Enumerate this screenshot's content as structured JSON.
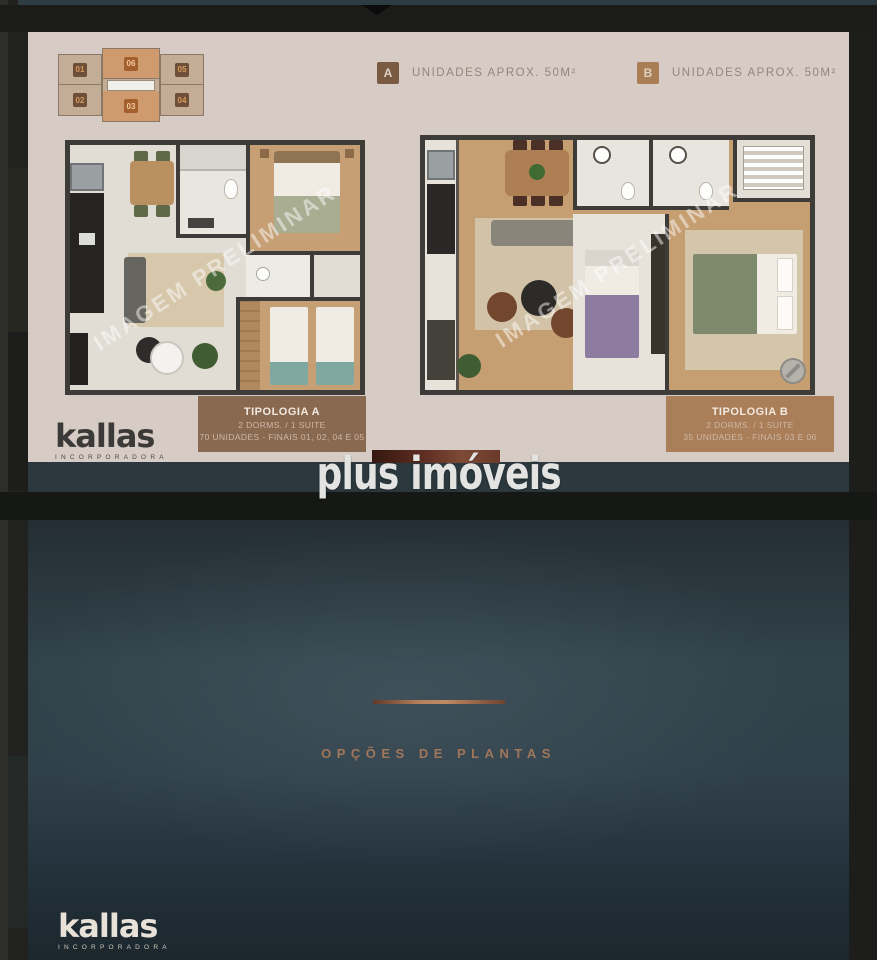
{
  "brand": {
    "wordmark": "kallas",
    "subtitle": "INCORPORADORA"
  },
  "overlay": {
    "watermark_text": "plus imóveis"
  },
  "top_slide": {
    "plan_watermark": "IMAGEM PRELIMINAR",
    "legend": [
      {
        "key": "A",
        "label": "UNIDADES APROX. 50M²"
      },
      {
        "key": "B",
        "label": "UNIDADES APROX. 50M²"
      }
    ],
    "keyplan_units": [
      {
        "id": "01"
      },
      {
        "id": "06"
      },
      {
        "id": "05"
      },
      {
        "id": "02"
      },
      {
        "id": "03"
      },
      {
        "id": "04"
      }
    ],
    "typologies": [
      {
        "title": "TIPOLOGIA A",
        "dorms": "2 DORMS. / 1 SUITE",
        "units": "70 UNIDADES - FINAIS 01, 02, 04 E 05"
      },
      {
        "title": "TIPOLOGIA B",
        "dorms": "2 DORMS. / 1 SUITE",
        "units": "35 UNIDADES - FINAIS 03 E 06"
      }
    ]
  },
  "bottom_slide": {
    "title": "OPÇÕES DE PLANTAS"
  },
  "colors": {
    "slide_background": "#d6ccc5",
    "legend_a_badge": "#7a5b42",
    "legend_b_badge": "#a97e54",
    "typology_a_bg": "#8a6951",
    "typology_b_bg": "#a97e58",
    "accent_copper": "#b5805c",
    "teal_dark": "#2e3d44",
    "keyplan_highlight": "#cf9a6e"
  }
}
